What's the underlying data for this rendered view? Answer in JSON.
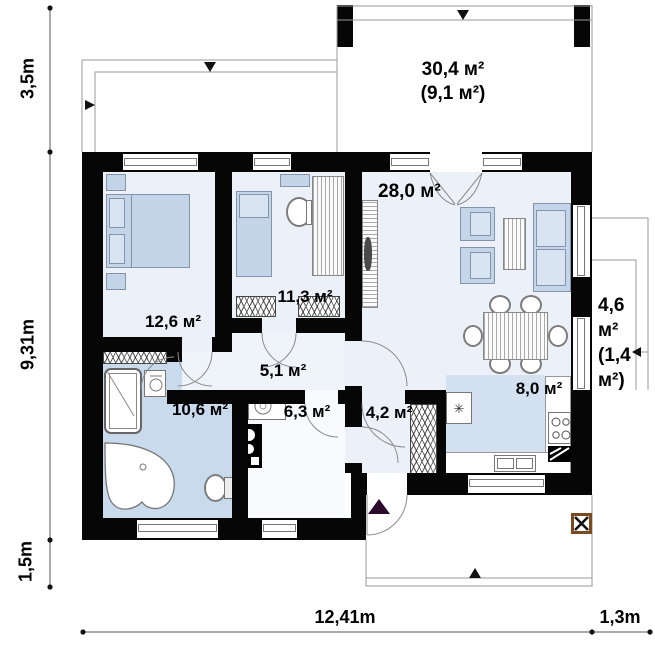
{
  "plan": {
    "rooms": {
      "terrace": {
        "area": "30,4 м²",
        "area_sub": "(9,1 м²)"
      },
      "living": {
        "area": "28,0 м²"
      },
      "bedroom1": {
        "area": "12,6 м²"
      },
      "bedroom2": {
        "area": "11,3 м²"
      },
      "hallway": {
        "area": "5,1 м²"
      },
      "bathroom": {
        "area": "10,6 м²"
      },
      "utility": {
        "area": "6,3 м²"
      },
      "entry": {
        "area": "4,2 м²"
      },
      "kitchen": {
        "area": "8,0 м²"
      },
      "side_terrace": {
        "lines": [
          "4,6",
          "м²",
          "(1,4",
          "м²)"
        ]
      }
    },
    "dimensions": {
      "terrace_depth": "3,5m",
      "house_depth": "9,31m",
      "porch_depth": "1,5m",
      "house_width": "12,41m",
      "side_width": "1,3m"
    },
    "icons": {
      "fridge": "✳"
    },
    "colors": {
      "wall": "#060606",
      "floor_light": "#ecf1f9",
      "floor_bath": "#c9daed",
      "floor_kitchen": "#d3e1f1",
      "furniture": "#c4d5ea",
      "column_border": "#7a4a21",
      "entry_marker": "#2b0a2b"
    }
  }
}
